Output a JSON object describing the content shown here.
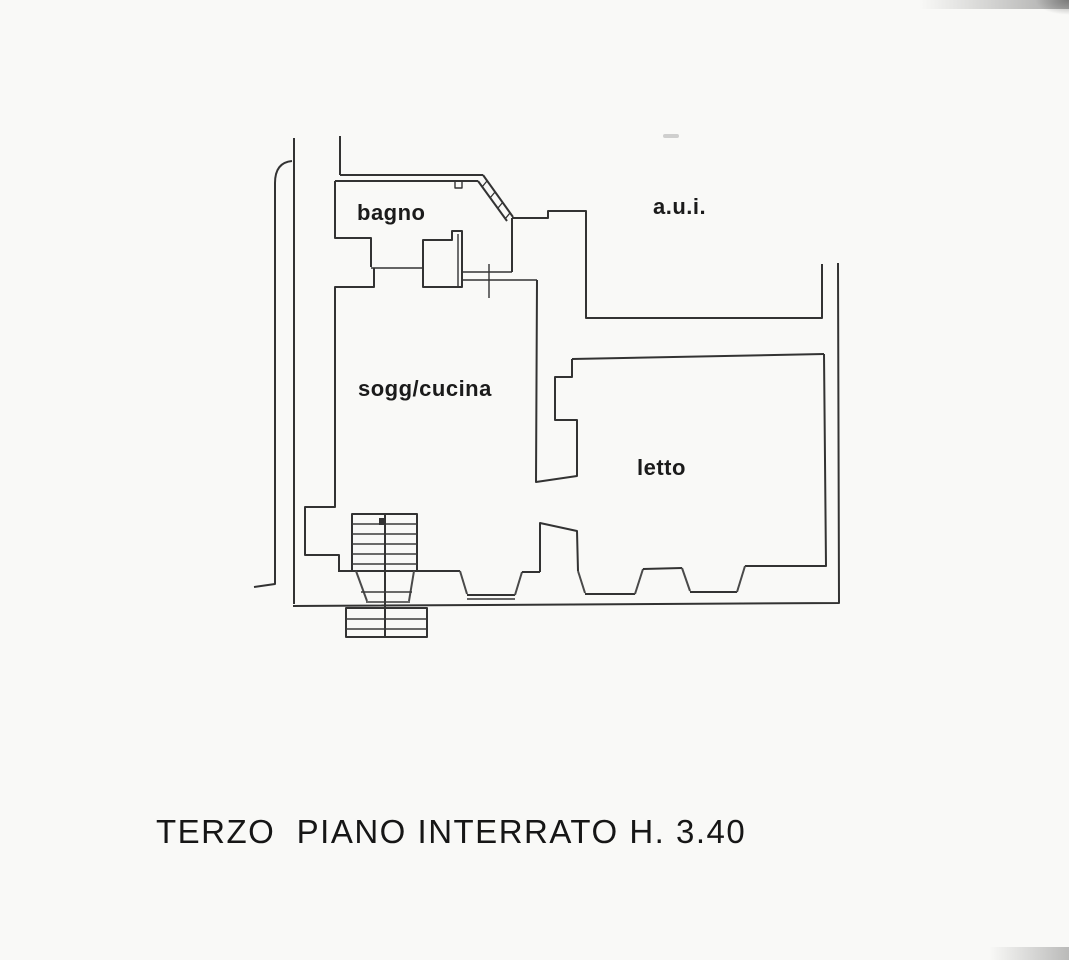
{
  "plan": {
    "caption": "TERZO  PIANO INTERRATO H. 3.40"
  },
  "rooms": [
    {
      "id": "bagno",
      "label": "bagno"
    },
    {
      "id": "aui",
      "label": "a.u.i."
    },
    {
      "id": "sogg-cucina",
      "label": "sogg/cucina"
    },
    {
      "id": "letto",
      "label": "letto"
    }
  ],
  "colors": {
    "line": "#333333",
    "background": "#f9f9f7",
    "text": "#1b1b1b"
  }
}
